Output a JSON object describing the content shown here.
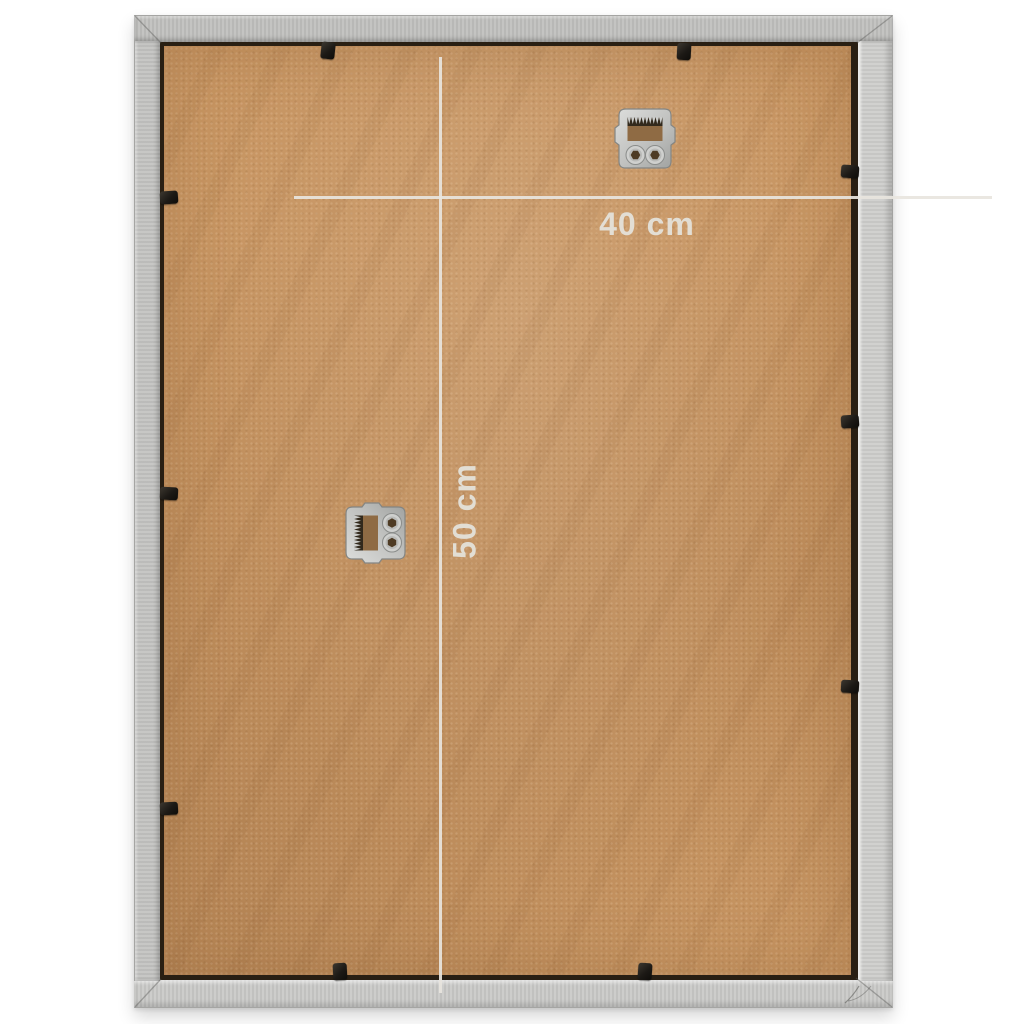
{
  "scene": {
    "title": "Back of a silver photo frame with MDF backing board",
    "background_color": "#ffffff"
  },
  "dimension_annotations": {
    "width": {
      "label": "40 cm"
    },
    "height": {
      "label": "50 cm"
    },
    "line_color": "#e8e5de",
    "text_color": "#e4e1da"
  },
  "frame": {
    "material": "silver aluminium, mitered corners",
    "face_color": "#c6c6c4",
    "edge_color": "#a4a4a2"
  },
  "backing_board": {
    "material": "MDF",
    "color": "#c79562",
    "shadow_gap_color": "#291f13"
  },
  "hardware": {
    "hanger_color": "#c8c9c7",
    "hangers": [
      {
        "name": "sawtooth-hanger-top",
        "orientation": "horizontal"
      },
      {
        "name": "sawtooth-hanger-left",
        "orientation": "vertical"
      }
    ],
    "clips": {
      "color": "#1f1b16",
      "top_count": 2,
      "bottom_count": 2,
      "left_count": 3,
      "right_count": 3
    }
  }
}
